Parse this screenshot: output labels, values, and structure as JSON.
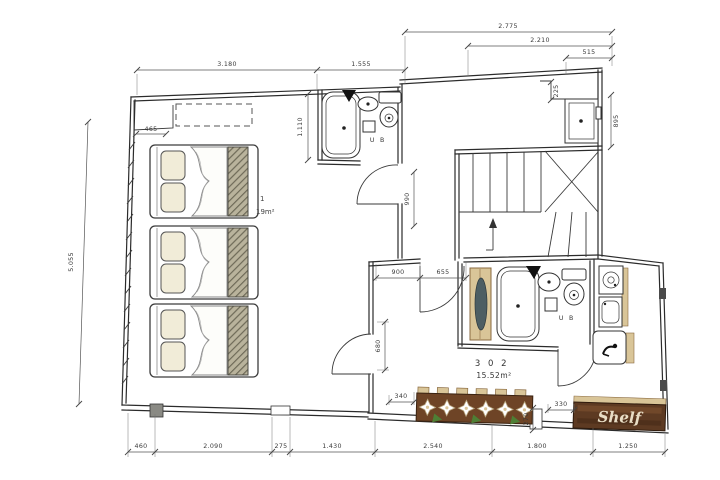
{
  "drawing": {
    "type": "architectural-floor-plan",
    "rooms": {
      "r301_label_fragment": "1",
      "r301_area_fragment": "19m²",
      "r302_label": "3 0 2",
      "r302_area": "15.52m²"
    },
    "fixtures": {
      "unit_bath_301": "U B",
      "unit_bath_302": "U B",
      "shelf_sign": "Shelf"
    },
    "dimensions": {
      "top_3180": "3.180",
      "top_1555": "1.555",
      "top_2775": "2.775",
      "top_2210": "2.210",
      "top_515": "515",
      "left_5055": "5.055",
      "v1110": "1.110",
      "v225": "225",
      "v895": "895",
      "v990": "990",
      "v680": "680",
      "v270": "270",
      "h465": "465",
      "h900": "900",
      "h655": "655",
      "h340": "340",
      "h330": "330",
      "b460": "460",
      "b2090": "2.090",
      "b275": "275",
      "b1430": "1.430",
      "b2540": "2.540",
      "b1800": "1.800",
      "b1250": "1.250"
    },
    "colors": {
      "ink": "#2b2b2b",
      "wood_dark": "#6e4426",
      "wood_light": "#d9c598",
      "hatch": "#b9b39c",
      "leaf_green": "#4e7f35",
      "sign_text": "#e9dec6"
    }
  }
}
